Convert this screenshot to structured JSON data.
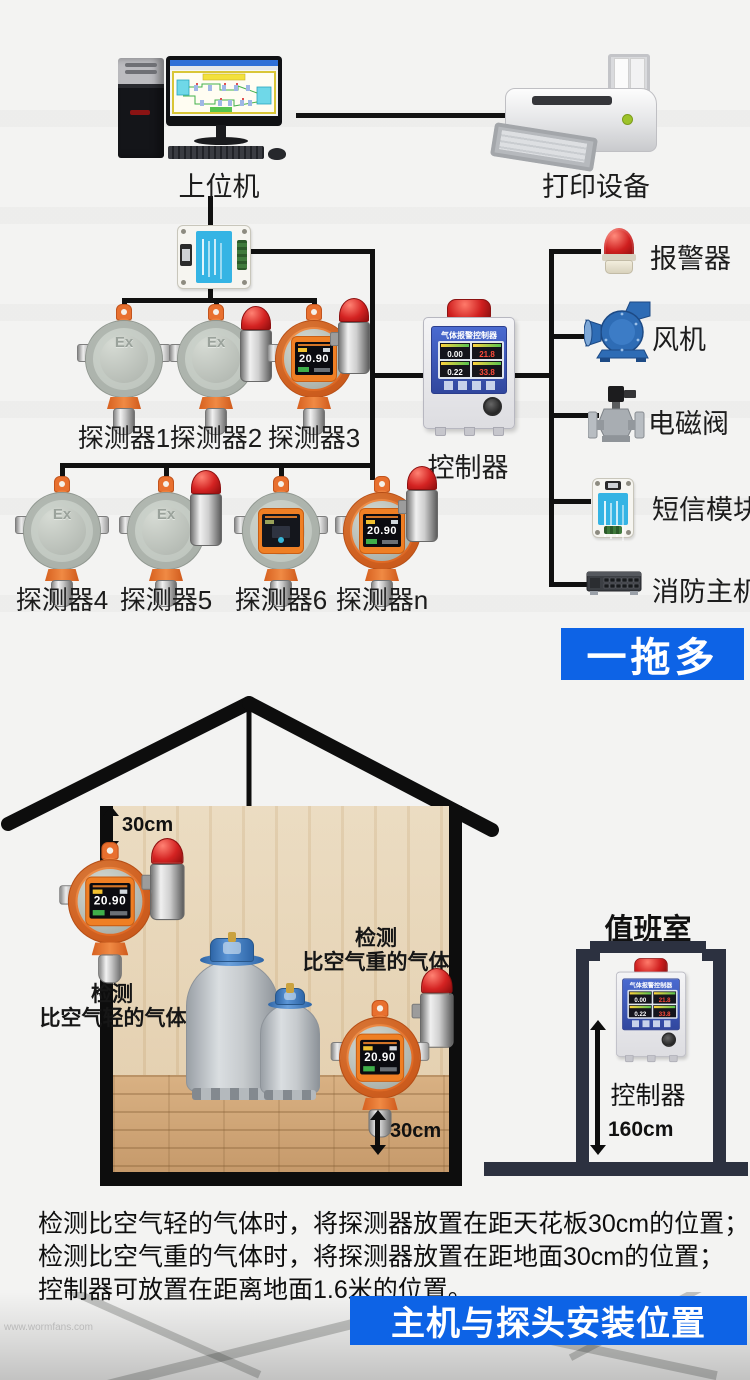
{
  "top": {
    "host_label": "上位机",
    "printer_label": "打印设备",
    "row1": [
      {
        "label": "探测器1"
      },
      {
        "label": "探测器2"
      },
      {
        "label": "探测器3"
      }
    ],
    "row2": [
      {
        "label": "探测器4"
      },
      {
        "label": "探测器5"
      },
      {
        "label": "探测器6"
      },
      {
        "label": "探测器n"
      }
    ],
    "controller": {
      "label": "控制器",
      "screen_title": "气体报警控制器",
      "readings": [
        "0.00",
        "21.8",
        "0.22",
        "33.8"
      ]
    },
    "peripherals": [
      {
        "label": "报警器"
      },
      {
        "label": "风机"
      },
      {
        "label": "电磁阀"
      },
      {
        "label": "短信模块"
      },
      {
        "label": "消防主机"
      }
    ],
    "banner": "一拖多",
    "ex_marking": "Ex",
    "display_value": "20.90"
  },
  "install": {
    "ceiling_gap": "30cm",
    "floor_gap": "30cm",
    "light_gas": [
      "检测",
      "比空气轻的气体"
    ],
    "heavy_gas": [
      "检测",
      "比空气重的气体"
    ],
    "duty_room": {
      "title": "值班室",
      "controller_label": "控制器",
      "height": "160cm"
    }
  },
  "footer": {
    "lines": [
      "检测比空气轻的气体时，将探测器放置在距天花板30cm的位置；",
      "检测比空气重的气体时，将探测器放置在距地面30cm的位置；",
      "控制器可放置在距离地面1.6米的位置。"
    ],
    "banner": "主机与探头安装位置",
    "watermark": "www.wormfans.com"
  },
  "colors": {
    "accent_blue": "#0d63e6",
    "line_black": "#101010",
    "detector_orange": "#e8702f",
    "frame_navy": "#2c3140"
  }
}
